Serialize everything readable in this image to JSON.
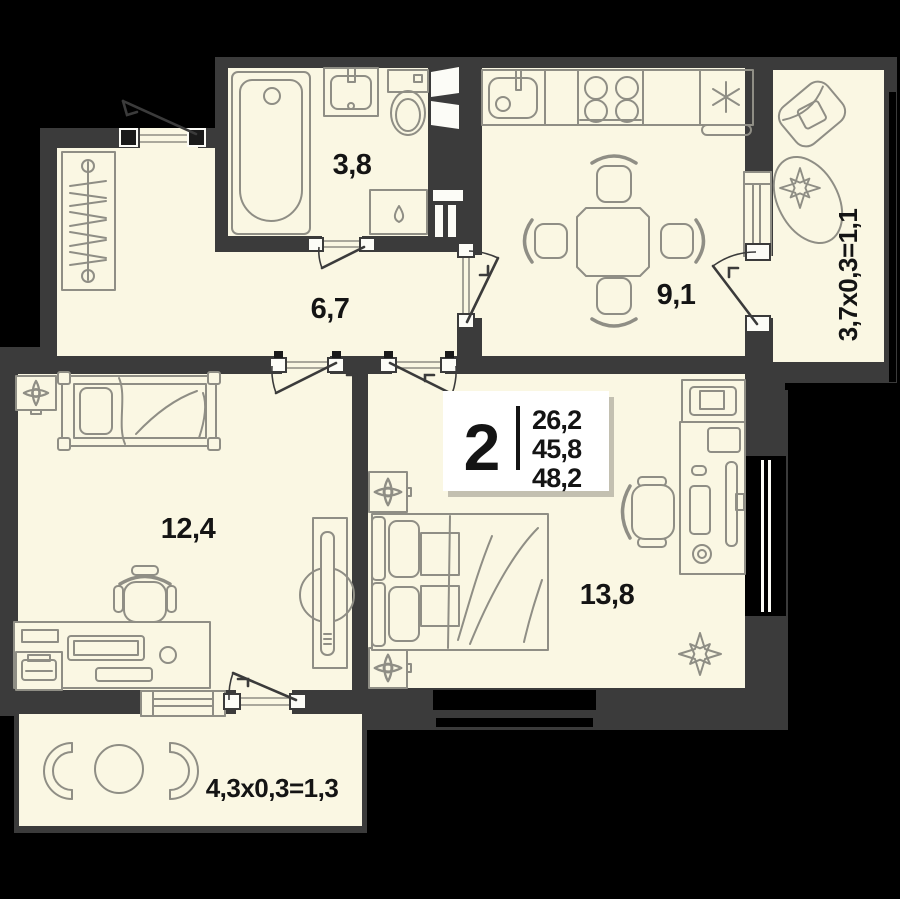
{
  "colors": {
    "background": "#000000",
    "wall": "#3b3b3b",
    "room_fill": "#faf7e3",
    "furniture_line": "#8f8e85",
    "label_text": "#141414",
    "badge_bg": "#ffffff"
  },
  "badge": {
    "room_count": "2",
    "area_values": [
      "26,2",
      "45,8",
      "48,2"
    ]
  },
  "room_labels": {
    "bathroom": "3,8",
    "hallway": "6,7",
    "kitchen": "9,1",
    "bedroom_left": "12,4",
    "bedroom_right": "13,8"
  },
  "balcony_labels": {
    "right": "3,7x0,3=1,1",
    "bottom": "4,3x0,3=1,3"
  }
}
